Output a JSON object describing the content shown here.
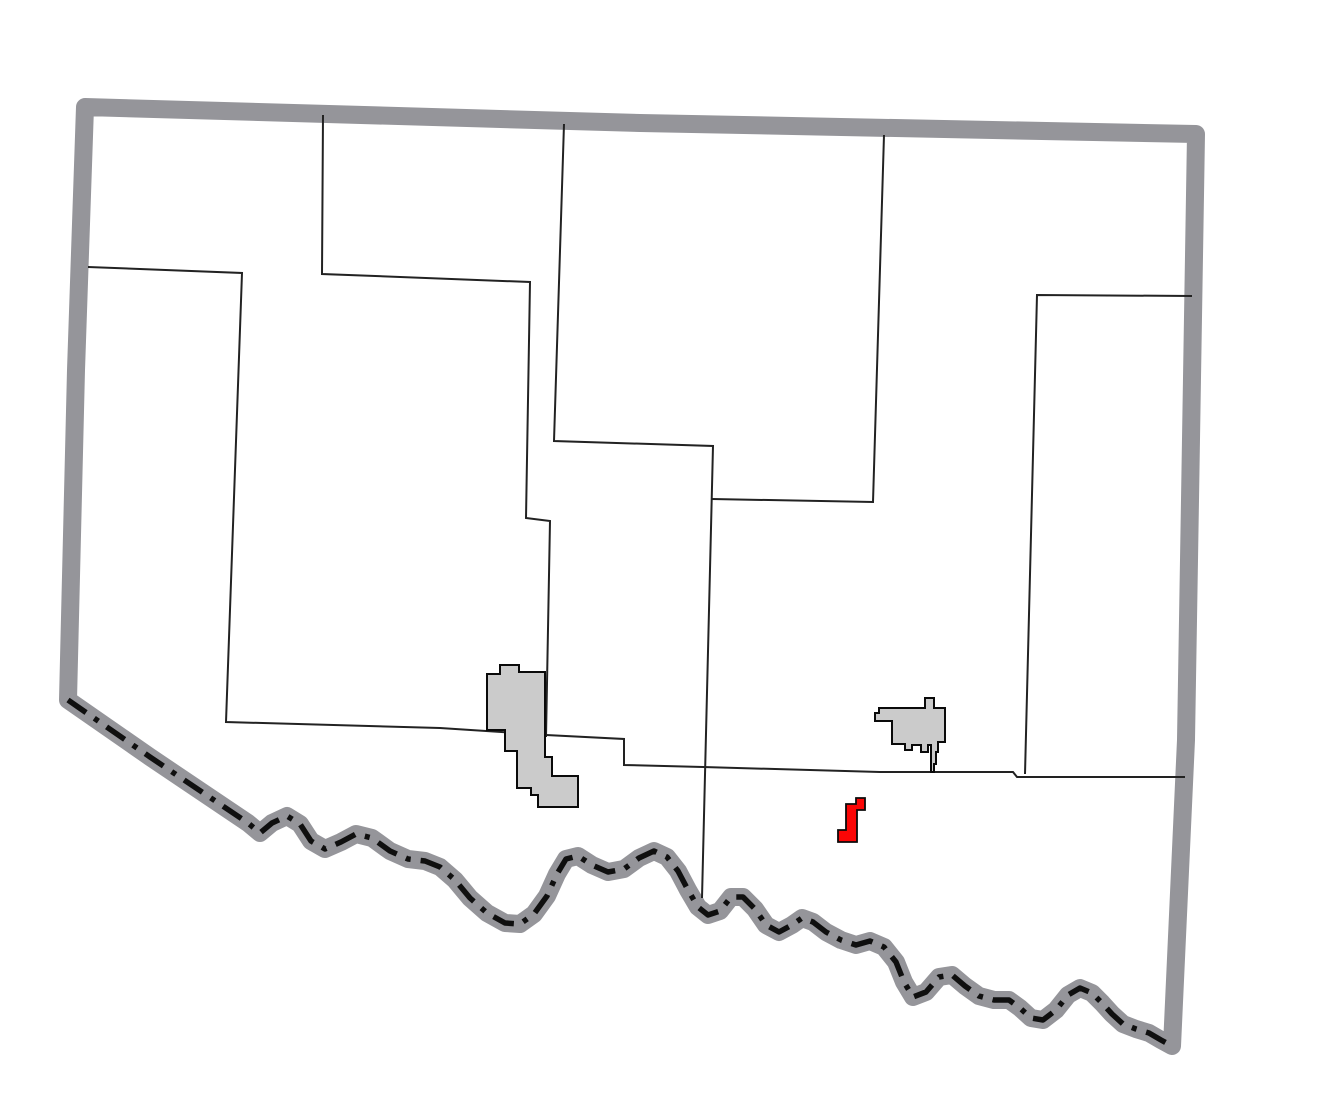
{
  "map": {
    "type": "county-locator",
    "canvas": {
      "width": 1320,
      "height": 1110,
      "background": "#ffffff"
    },
    "colors": {
      "county_border": "#95959a",
      "county_fill": "#ffffff",
      "township_line": "#222222",
      "river_dashdot": "#0f0f0f",
      "city_fill": "#cbcbcb",
      "city_outline": "#0a0a0a",
      "highlight_fill": "#fb0606",
      "highlight_outline": "#0a0a0a"
    },
    "strokes": {
      "county_border_width": 18,
      "township_line_width": 2,
      "river_dash_width": 5.5,
      "river_dash_pattern": "22 10 5 10",
      "city_outline_width": 2,
      "highlight_outline_width": 1.8
    },
    "county": {
      "top_edge": [
        [
          85,
          107
        ],
        [
          640,
          123
        ],
        [
          1196,
          134
        ]
      ],
      "right_edge": [
        [
          1190,
          500
        ],
        [
          1186,
          740
        ],
        [
          1172,
          1046
        ]
      ],
      "left_return": [
        [
          76,
          370
        ]
      ],
      "river": [
        [
          68,
          700
        ],
        [
          150,
          757
        ],
        [
          248,
          823
        ],
        [
          260,
          833
        ],
        [
          272,
          823
        ],
        [
          287,
          816
        ],
        [
          300,
          824
        ],
        [
          311,
          841
        ],
        [
          325,
          849
        ],
        [
          341,
          842
        ],
        [
          356,
          834
        ],
        [
          372,
          838
        ],
        [
          390,
          851
        ],
        [
          408,
          859
        ],
        [
          425,
          861
        ],
        [
          440,
          867
        ],
        [
          455,
          880
        ],
        [
          470,
          898
        ],
        [
          487,
          913
        ],
        [
          505,
          923
        ],
        [
          520,
          924
        ],
        [
          534,
          914
        ],
        [
          547,
          896
        ],
        [
          557,
          874
        ],
        [
          566,
          859
        ],
        [
          578,
          856
        ],
        [
          592,
          865
        ],
        [
          608,
          872
        ],
        [
          624,
          869
        ],
        [
          639,
          858
        ],
        [
          654,
          851
        ],
        [
          667,
          857
        ],
        [
          678,
          871
        ],
        [
          688,
          890
        ],
        [
          698,
          907
        ],
        [
          708,
          915
        ],
        [
          720,
          911
        ],
        [
          731,
          897
        ],
        [
          743,
          897
        ],
        [
          755,
          909
        ],
        [
          766,
          925
        ],
        [
          779,
          932
        ],
        [
          792,
          925
        ],
        [
          802,
          918
        ],
        [
          813,
          922
        ],
        [
          826,
          932
        ],
        [
          841,
          940
        ],
        [
          856,
          945
        ],
        [
          870,
          941
        ],
        [
          884,
          947
        ],
        [
          896,
          962
        ],
        [
          904,
          982
        ],
        [
          913,
          997
        ],
        [
          926,
          992
        ],
        [
          939,
          977
        ],
        [
          952,
          975
        ],
        [
          965,
          986
        ],
        [
          979,
          996
        ],
        [
          994,
          1000
        ],
        [
          1009,
          1000
        ],
        [
          1020,
          1008
        ],
        [
          1031,
          1018
        ],
        [
          1043,
          1020
        ],
        [
          1056,
          1010
        ],
        [
          1068,
          995
        ],
        [
          1080,
          988
        ],
        [
          1092,
          993
        ],
        [
          1102,
          1003
        ],
        [
          1112,
          1014
        ],
        [
          1123,
          1024
        ],
        [
          1136,
          1029
        ],
        [
          1149,
          1033
        ],
        [
          1161,
          1040
        ],
        [
          1172,
          1046
        ]
      ]
    },
    "township_lines": [
      {
        "name": "township-line-northwest",
        "points": [
          [
            323,
            115
          ],
          [
            322,
            274
          ],
          [
            530,
            282
          ],
          [
            526,
            518
          ],
          [
            550,
            521
          ],
          [
            546,
            737
          ]
        ]
      },
      {
        "name": "township-line-central",
        "points": [
          [
            564,
            124
          ],
          [
            554,
            441
          ],
          [
            713,
            446
          ],
          [
            702,
            898
          ]
        ]
      },
      {
        "name": "township-line-northeast",
        "points": [
          [
            884,
            135
          ],
          [
            873,
            502
          ],
          [
            712,
            499
          ]
        ]
      },
      {
        "name": "township-line-east",
        "points": [
          [
            1192,
            296
          ],
          [
            1037,
            295
          ],
          [
            1025,
            774
          ]
        ]
      },
      {
        "name": "township-line-south",
        "points": [
          [
            88,
            267
          ],
          [
            242,
            273
          ],
          [
            226,
            722
          ],
          [
            440,
            728
          ],
          [
            546,
            735
          ],
          [
            624,
            739
          ],
          [
            624,
            765
          ],
          [
            703,
            767
          ],
          [
            880,
            772
          ],
          [
            1013,
            772
          ],
          [
            1017,
            777
          ],
          [
            1185,
            777
          ]
        ]
      }
    ],
    "cities": [
      {
        "name": "city-polygon-west",
        "points": [
          [
            487,
            674
          ],
          [
            500,
            674
          ],
          [
            500,
            665
          ],
          [
            519,
            665
          ],
          [
            519,
            672
          ],
          [
            545,
            672
          ],
          [
            545,
            757
          ],
          [
            552,
            757
          ],
          [
            552,
            776
          ],
          [
            578,
            776
          ],
          [
            578,
            807
          ],
          [
            538,
            807
          ],
          [
            538,
            795
          ],
          [
            531,
            795
          ],
          [
            531,
            788
          ],
          [
            517,
            788
          ],
          [
            517,
            751
          ],
          [
            505,
            751
          ],
          [
            505,
            730
          ],
          [
            487,
            730
          ]
        ]
      },
      {
        "name": "city-polygon-east",
        "points": [
          [
            879,
            708
          ],
          [
            925,
            708
          ],
          [
            925,
            698
          ],
          [
            934,
            698
          ],
          [
            934,
            708
          ],
          [
            945,
            708
          ],
          [
            945,
            742
          ],
          [
            938,
            742
          ],
          [
            938,
            752
          ],
          [
            936,
            752
          ],
          [
            936,
            764
          ],
          [
            934,
            764
          ],
          [
            934,
            772
          ],
          [
            931,
            772
          ],
          [
            931,
            745
          ],
          [
            928,
            745
          ],
          [
            928,
            752
          ],
          [
            921,
            752
          ],
          [
            921,
            745
          ],
          [
            912,
            745
          ],
          [
            912,
            750
          ],
          [
            905,
            750
          ],
          [
            905,
            744
          ],
          [
            892,
            744
          ],
          [
            892,
            721
          ],
          [
            875,
            721
          ],
          [
            875,
            713
          ],
          [
            879,
            713
          ]
        ]
      }
    ],
    "highlight": {
      "name": "highlighted-community",
      "points": [
        [
          846,
          804
        ],
        [
          856,
          804
        ],
        [
          856,
          798
        ],
        [
          865,
          798
        ],
        [
          865,
          810
        ],
        [
          857,
          810
        ],
        [
          857,
          842
        ],
        [
          838,
          842
        ],
        [
          838,
          830
        ],
        [
          846,
          830
        ]
      ]
    }
  }
}
